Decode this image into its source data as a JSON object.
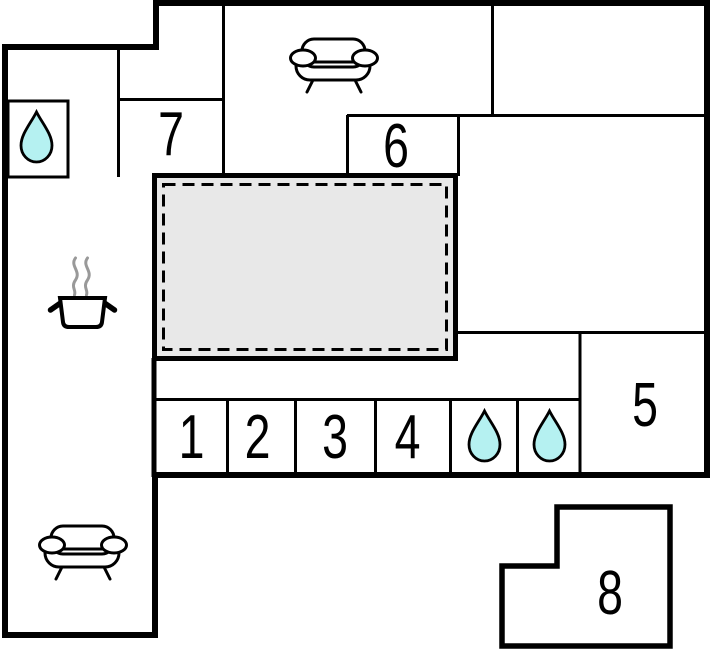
{
  "document": {
    "type": "floor-plan"
  },
  "colors": {
    "background": "#ffffff",
    "wall": "#000000",
    "terrace_fill": "#e8e8e8",
    "water_drop_fill": "#b5f1f1",
    "steam": "#999999"
  },
  "rooms": [
    {
      "name": "room-1",
      "label": "1"
    },
    {
      "name": "room-2",
      "label": "2"
    },
    {
      "name": "room-3",
      "label": "3"
    },
    {
      "name": "room-4",
      "label": "4"
    },
    {
      "name": "room-5",
      "label": "5"
    },
    {
      "name": "room-6",
      "label": "6"
    },
    {
      "name": "room-7",
      "label": "7"
    },
    {
      "name": "room-8",
      "label": "8"
    }
  ],
  "features": [
    {
      "name": "terrace",
      "style": "gray-dashed-area"
    },
    {
      "name": "bathroom-top-left",
      "icon": "water-drop"
    },
    {
      "name": "bathroom-row-1",
      "icon": "water-drop"
    },
    {
      "name": "bathroom-row-2",
      "icon": "water-drop"
    },
    {
      "name": "living-room-top",
      "icon": "sofa"
    },
    {
      "name": "lounge-bottom-left",
      "icon": "sofa"
    },
    {
      "name": "kitchen",
      "icon": "steaming-pot"
    }
  ]
}
